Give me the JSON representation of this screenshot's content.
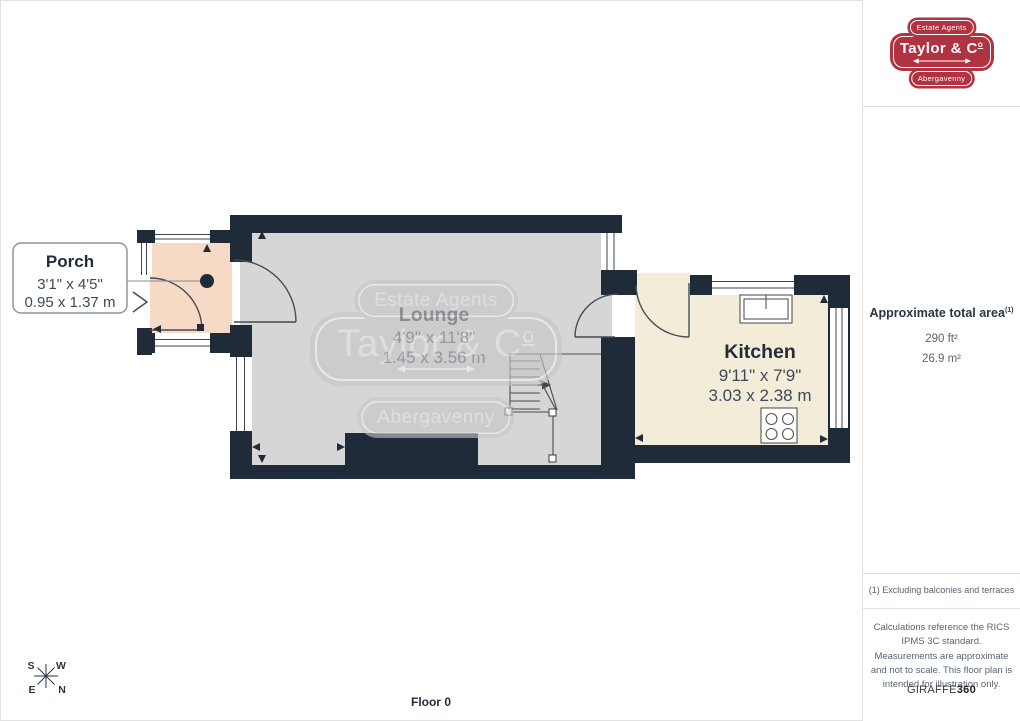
{
  "plan": {
    "floor_label": "Floor 0",
    "porch": {
      "name": "Porch",
      "imperial": "3'1\" x 4'5\"",
      "metric": "0.95 x 1.37 m"
    },
    "lounge": {
      "name": "Lounge",
      "imperial": "4'9\" x 11'8\"",
      "metric": "1.45 x 3.56 m"
    },
    "kitchen": {
      "name": "Kitchen",
      "imperial": "9'11\" x 7'9\"",
      "metric": "3.03 x 2.38 m"
    },
    "compass": {
      "n": "N",
      "e": "E",
      "s": "S",
      "w": "W"
    },
    "watermark": {
      "top": "Estate Agents",
      "main": "Taylor & C",
      "main_sup": "o",
      "bottom": "Abergavenny"
    }
  },
  "sidebar": {
    "logo": {
      "top": "Estate Agents",
      "main": "Taylor & C",
      "main_sup": "o",
      "bottom": "Abergavenny"
    },
    "area": {
      "title": "Approximate total area",
      "footnote_ref": "(1)",
      "imperial": "290 ft²",
      "metric": "26.9 m²"
    },
    "footnote": "(1) Excluding balconies and terraces",
    "disclaimer": "Calculations reference the RICS IPMS 3C standard. Measurements are approximate and not to scale. This floor plan is intended for illustration only.",
    "credit": {
      "brand": "GIRAFFE",
      "suffix": "360"
    }
  },
  "colors": {
    "wall": "#202b3a",
    "lounge_floor": "#d6d6d7",
    "porch_floor": "#f7dac5",
    "kitchen_floor": "#f3ecd8",
    "brand_red": "#b13240",
    "text_dark": "#232c3a",
    "text_muted": "#5a6472",
    "divider": "#e0e0e0"
  }
}
